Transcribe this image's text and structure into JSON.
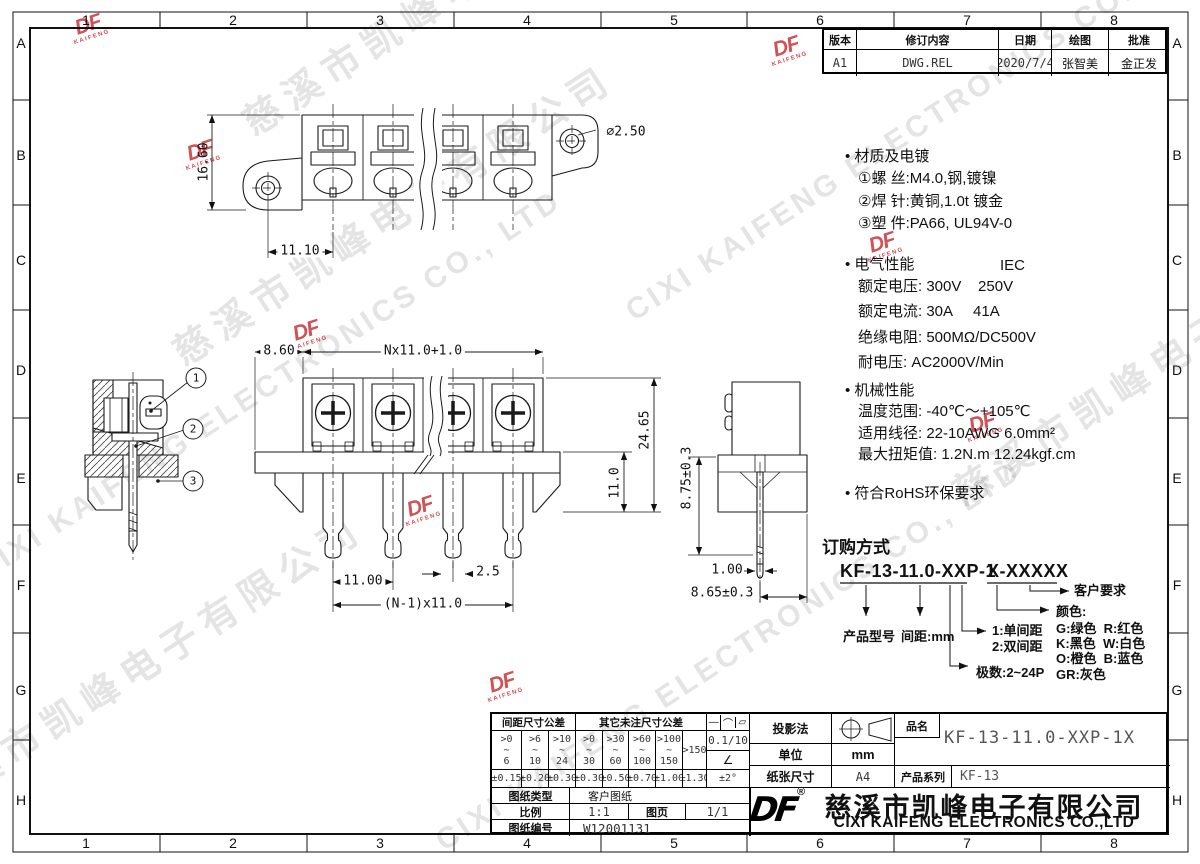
{
  "zones": {
    "cols": [
      "1",
      "2",
      "3",
      "4",
      "5",
      "6",
      "7",
      "8"
    ],
    "rows": [
      "A",
      "B",
      "C",
      "D",
      "E",
      "F",
      "G",
      "H"
    ]
  },
  "revision": {
    "headers": [
      "版本",
      "修订内容",
      "日期",
      "绘图",
      "批准"
    ],
    "row": [
      "A1",
      "DWG.REL",
      "2020/7/4",
      "张智美",
      "金正发"
    ]
  },
  "specs": {
    "s1_title": "• 材质及电镀",
    "s1_l1": "①螺 丝:M4.0,钢,镀镍",
    "s1_l2": "②焊 针:黄铜,1.0t 镀金",
    "s1_l3": "③塑 件:PA66, UL94V-0",
    "s2_title": "• 电气性能",
    "s2_iec": "IEC",
    "s2_l1": "额定电压: 300V    250V",
    "s2_l2": "额定电流: 30A     41A",
    "s2_l3": "绝缘电阻: 500MΩ/DC500V",
    "s2_l4": "耐电压: AC2000V/Min",
    "s3_title": "• 机械性能",
    "s3_l1": "温度范围: -40℃～+105℃",
    "s3_l2": "适用线径: 22-10AWG 6.0mm²",
    "s3_l3": "最大扭矩值: 1.2N.m 12.24kgf.cm",
    "s4_title": "• 符合RoHS环保要求"
  },
  "ordering": {
    "title": "订购方式",
    "code_main": "KF-13-11.0-XXP-1",
    "code_suffix": "X-XXXXX",
    "product_model": "产品型号",
    "pitch": "间距:mm",
    "single": "1:单间距",
    "double": "2:双间距",
    "poles": "极数:2~24P",
    "color_title": "颜色:",
    "color_l1": "G:绿色  R:红色",
    "color_l2": "K:黑色  W:白色",
    "color_l3": "O:橙色  B:蓝色",
    "color_l4": "GR:灰色",
    "customer": "客户要求"
  },
  "dimensions": {
    "top": {
      "height": "16.60",
      "pitch": "11.10",
      "hole": "⌀2.50"
    },
    "front": {
      "left": "8.60",
      "span": "Nx11.0+1.0",
      "total_height": "24.65",
      "pin_len": "11.0",
      "pitch": "11.00",
      "pin_w": "2.5",
      "span2": "(N-1)x11.0"
    },
    "side": {
      "height": "8.75±0.3",
      "pin_w": "1.00",
      "offset": "8.65±0.3"
    },
    "callouts": [
      "1",
      "2",
      "3"
    ]
  },
  "tolerance": {
    "pitch_header": "间距尺寸公差",
    "other_header": "其它未注尺寸公差",
    "sym1": "—",
    "sym2": "⌒",
    "sym3": "▱",
    "ranges": [
      ">0\n~\n6",
      ">6\n~\n10",
      ">10\n~\n24",
      ">0\n~\n30",
      ">30\n~\n60",
      ">60\n~\n100",
      ">100\n~\n150"
    ],
    "range8": ">150",
    "tols": [
      "±0.15",
      "±0.20",
      "±0.30",
      "±0.30",
      "±0.50",
      "±0.70",
      "±1.00",
      "±1.30"
    ],
    "flatness": "0.1/10",
    "angle_sym": "∠",
    "angle": "±2°"
  },
  "titleblock": {
    "projection_label": "投影法",
    "unit_label": "单位",
    "unit": "mm",
    "paper_label": "纸张尺寸",
    "paper": "A4",
    "name_label": "品名",
    "name": "KF-13-11.0-XXP-1X",
    "series_label": "产品系列",
    "series": "KF-13",
    "type_label": "图纸类型",
    "type": "客户图纸",
    "scale_label": "比例",
    "scale": "1:1",
    "page_label": "图页",
    "page": "1/1",
    "no_label": "图纸编号",
    "no": "W12001131",
    "logo": "DF",
    "reg": "®",
    "company_cn": "慈溪市凯峰电子有限公司",
    "company_en": "CIXI KAIFENG ELECTRONICS CO.,LTD"
  },
  "watermark": {
    "cn": "慈溪市凯峰电子有限公司",
    "en": "CIXI KAIFENG ELECTRONICS CO., LTD",
    "logo": "DF",
    "logo_sub": "KAIFENG"
  }
}
